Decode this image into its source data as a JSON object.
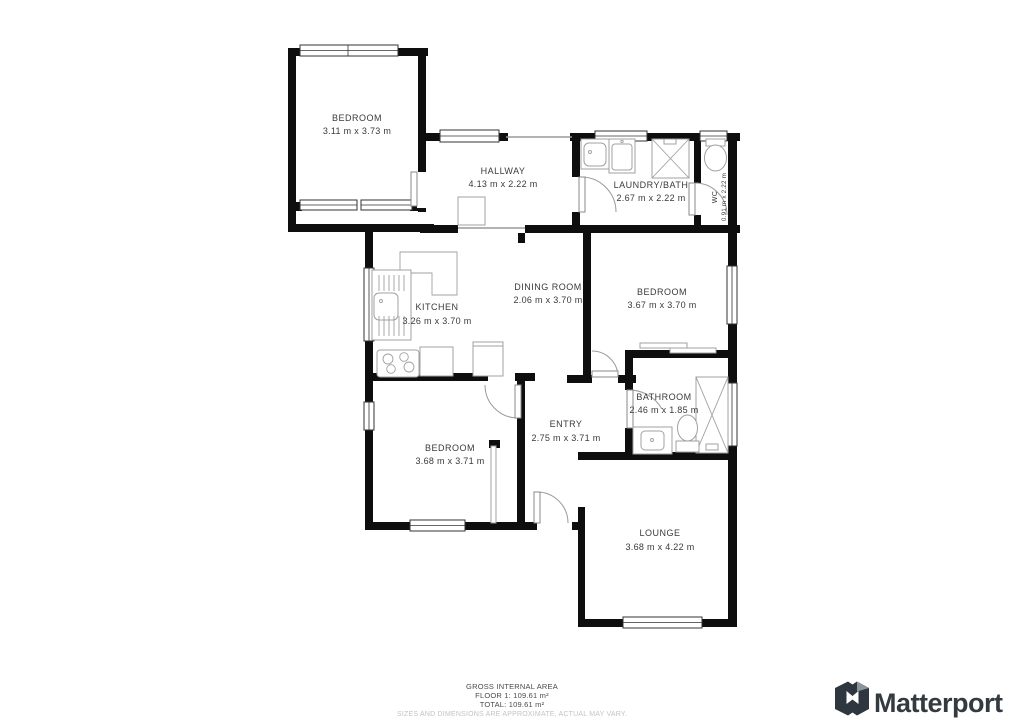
{
  "floorplan": {
    "rooms": [
      {
        "name": "BEDROOM",
        "dims": "3.11 m x 3.73 m"
      },
      {
        "name": "HALLWAY",
        "dims": "4.13 m x 2.22 m"
      },
      {
        "name": "LAUNDRY/BATH",
        "dims": "2.67 m x 2.22 m"
      },
      {
        "name": "WC",
        "dims": "0.91 m x 2.22 m"
      },
      {
        "name": "KITCHEN",
        "dims": "3.26 m x 3.70 m"
      },
      {
        "name": "DINING ROOM",
        "dims": "2.06 m x 3.70 m"
      },
      {
        "name": "BEDROOM",
        "dims": "3.67 m x 3.70 m"
      },
      {
        "name": "ENTRY",
        "dims": "2.75 m x 3.71 m"
      },
      {
        "name": "BATHROOM",
        "dims": "2.46 m x 1.85 m"
      },
      {
        "name": "BEDROOM",
        "dims": "3.68 m x 3.71 m"
      },
      {
        "name": "LOUNGE",
        "dims": "3.68 m x 4.22 m"
      }
    ],
    "fixtures": [
      "kitchen-sink",
      "stove",
      "fridge",
      "hall-closet",
      "laundry-sink",
      "washing-machine",
      "shower",
      "wc-toilet",
      "bath-tub",
      "bathroom-toilet",
      "vanity-sink",
      "closet-sliders"
    ]
  },
  "footer": {
    "title": "GROSS INTERNAL AREA",
    "floor_line": "FLOOR 1: 109.61 m²",
    "total_line": "TOTAL: 109.61 m²",
    "disclaimer": "SIZES AND DIMENSIONS ARE APPROXIMATE, ACTUAL MAY VARY."
  },
  "branding": {
    "logo_text": "Matterport"
  },
  "colors": {
    "wall": "#0e0e0e",
    "label": "#3a3a3a",
    "fixture": "#a0a0a0",
    "logo": "#333b41",
    "disclaimer": "#c3c3c3"
  }
}
